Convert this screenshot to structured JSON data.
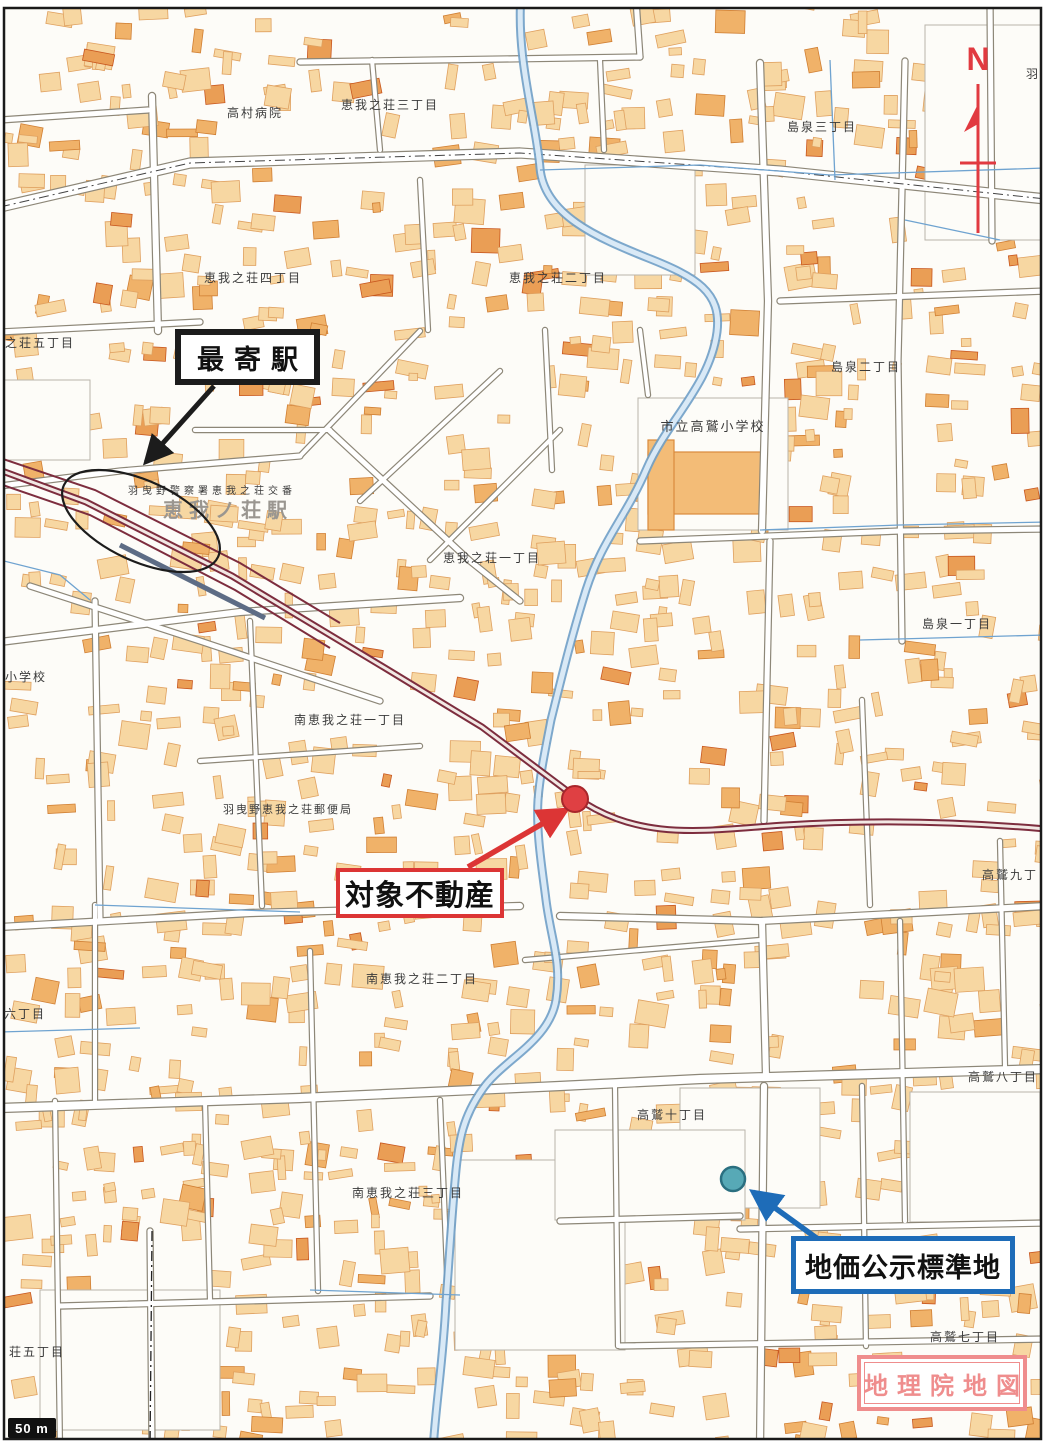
{
  "map": {
    "source_label": "地理院地図",
    "scale_bar": {
      "label": "50 m"
    },
    "compass": {
      "label": "N",
      "color": "#e13a40"
    },
    "station_area": {
      "police_box_label": "羽曳野警察署恵我之荘交番",
      "station_name": "恵我ノ荘駅"
    },
    "annotations": {
      "nearest_station": {
        "label": "最寄駅",
        "border_color": "#1c1c1c"
      },
      "subject_property": {
        "label": "対象不動産",
        "border_color": "#dc3535",
        "marker_color": "#df4043"
      },
      "land_price_site": {
        "label": "地価公示標準地",
        "border_color": "#1e6cb8",
        "marker_color": "#57a9b6"
      },
      "source": {
        "label": "地理院地図",
        "color": "#ef8d8d"
      }
    },
    "place_labels": [
      {
        "text": "高村病院",
        "x": 255,
        "y": 117
      },
      {
        "text": "恵我之荘三丁目",
        "x": 390,
        "y": 109
      },
      {
        "text": "島泉三丁目",
        "x": 822,
        "y": 131
      },
      {
        "text": "羽",
        "x": 1033,
        "y": 78
      },
      {
        "text": "恵我之荘四丁目",
        "x": 253,
        "y": 282
      },
      {
        "text": "恵我之荘二丁目",
        "x": 558,
        "y": 282
      },
      {
        "text": "之荘五丁目",
        "x": 40,
        "y": 347
      },
      {
        "text": "島泉二丁目",
        "x": 866,
        "y": 371
      },
      {
        "text": "市立高鷲小学校",
        "x": 713,
        "y": 431,
        "size": 13
      },
      {
        "text": "恵我之荘一丁目",
        "x": 492,
        "y": 562
      },
      {
        "text": "島泉一丁目",
        "x": 957,
        "y": 628
      },
      {
        "text": "小学校",
        "x": 26,
        "y": 681
      },
      {
        "text": "南恵我之荘一丁目",
        "x": 350,
        "y": 724
      },
      {
        "text": "羽曳野恵我之荘郵便局",
        "x": 288,
        "y": 813,
        "size": 11
      },
      {
        "text": "高鷲九丁",
        "x": 1010,
        "y": 879
      },
      {
        "text": "南恵我之荘二丁目",
        "x": 422,
        "y": 983
      },
      {
        "text": "六丁目",
        "x": 25,
        "y": 1018
      },
      {
        "text": "高鷲八丁目",
        "x": 1003,
        "y": 1081
      },
      {
        "text": "高鷲十丁目",
        "x": 672,
        "y": 1119
      },
      {
        "text": "南恵我之荘三丁目",
        "x": 408,
        "y": 1197
      },
      {
        "text": "荘五丁目",
        "x": 37,
        "y": 1356
      },
      {
        "text": "高鷲七丁目",
        "x": 965,
        "y": 1341
      },
      {
        "text": "羽曳野警察署恵我之荘交番",
        "x": 212,
        "y": 494,
        "size": 10,
        "spacing": 4
      },
      {
        "text": "恵我ノ荘駅",
        "x": 228,
        "y": 517,
        "size": 20,
        "color": "#9a9690",
        "weight": "bold",
        "spacing": 6
      }
    ],
    "colors": {
      "building_fill": "#f7d7a2",
      "building_mid": "#f0b269",
      "building_bold": "#ea9e55",
      "road_casing": "#8d8778",
      "river_edge": "#6f9ec6",
      "river_fill": "#d9e9f6",
      "channel_blue": "#6fa3d0",
      "railway": "#7d2d3e",
      "label_ink": "#3a3a3a",
      "frame_ink": "#1a1a1a"
    }
  }
}
